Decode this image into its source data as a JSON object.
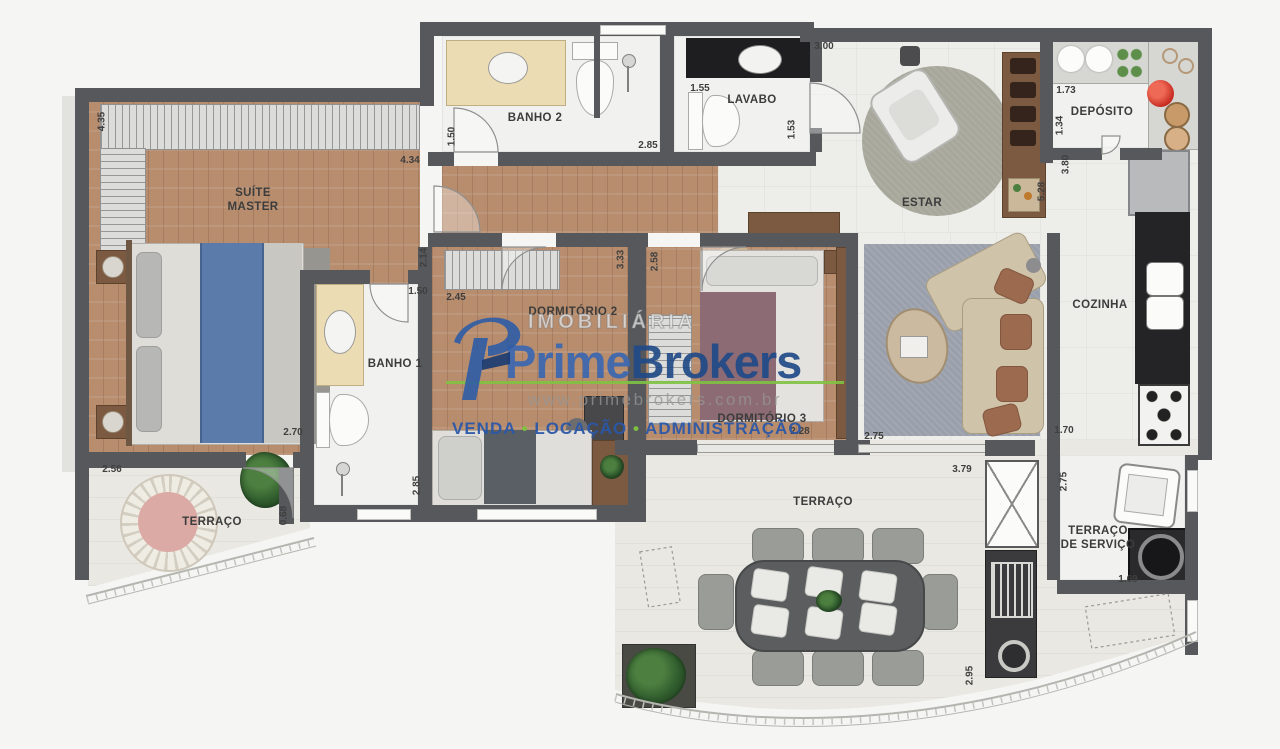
{
  "watermark": {
    "agency_type": "IMOBILIÁRIA",
    "brand_prime": "Prime",
    "brand_brokers": "Brokers",
    "website": "www.primebrokers.com.br",
    "services": {
      "venda": "VENDA",
      "locacao": "LOCAÇÃO",
      "administracao": "ADMINISTRAÇÃO",
      "separator": "•"
    },
    "colors": {
      "prime_blue": "#3a67b1",
      "brokers_blue": "#1f4a87",
      "green": "#7fc241",
      "gray_text": "#a9a9a9"
    }
  },
  "plan": {
    "colors": {
      "wall": "#57585b",
      "wood_floor": "#b78d6e",
      "tile_floor": "#edeeea",
      "terrace_floor": "#e9e8e2"
    },
    "rooms": [
      {
        "label": "SUÍTE MASTER"
      },
      {
        "label": "BANHO 2"
      },
      {
        "label": "LAVABO"
      },
      {
        "label": "ESTAR"
      },
      {
        "label": "DEPÓSITO"
      },
      {
        "label": "BANHO 1"
      },
      {
        "label": "DORMITÓRIO 2"
      },
      {
        "label": "DORMITÓRIO 3"
      },
      {
        "label": "COZINHA"
      },
      {
        "label": "TERRAÇO"
      },
      {
        "label": "TERRAÇO"
      },
      {
        "label": "TERRAÇO DE SERVIÇO"
      }
    ],
    "dimensions_m": [
      {
        "value": "4.35"
      },
      {
        "value": "4.34"
      },
      {
        "value": "1.50"
      },
      {
        "value": "2.85"
      },
      {
        "value": "1.55"
      },
      {
        "value": "1.53"
      },
      {
        "value": "3.00"
      },
      {
        "value": "1.73"
      },
      {
        "value": "1.34"
      },
      {
        "value": "3.80"
      },
      {
        "value": "5.28"
      },
      {
        "value": "2.14"
      },
      {
        "value": "1.50"
      },
      {
        "value": "2.45"
      },
      {
        "value": "3.33"
      },
      {
        "value": "2.58"
      },
      {
        "value": "2.70"
      },
      {
        "value": "2.56"
      },
      {
        "value": "0.68"
      },
      {
        "value": "2.85"
      },
      {
        "value": "2.28"
      },
      {
        "value": "2.75"
      },
      {
        "value": "1.70"
      },
      {
        "value": "3.79"
      },
      {
        "value": "2.75"
      },
      {
        "value": "1.69"
      },
      {
        "value": "2.95"
      }
    ]
  }
}
